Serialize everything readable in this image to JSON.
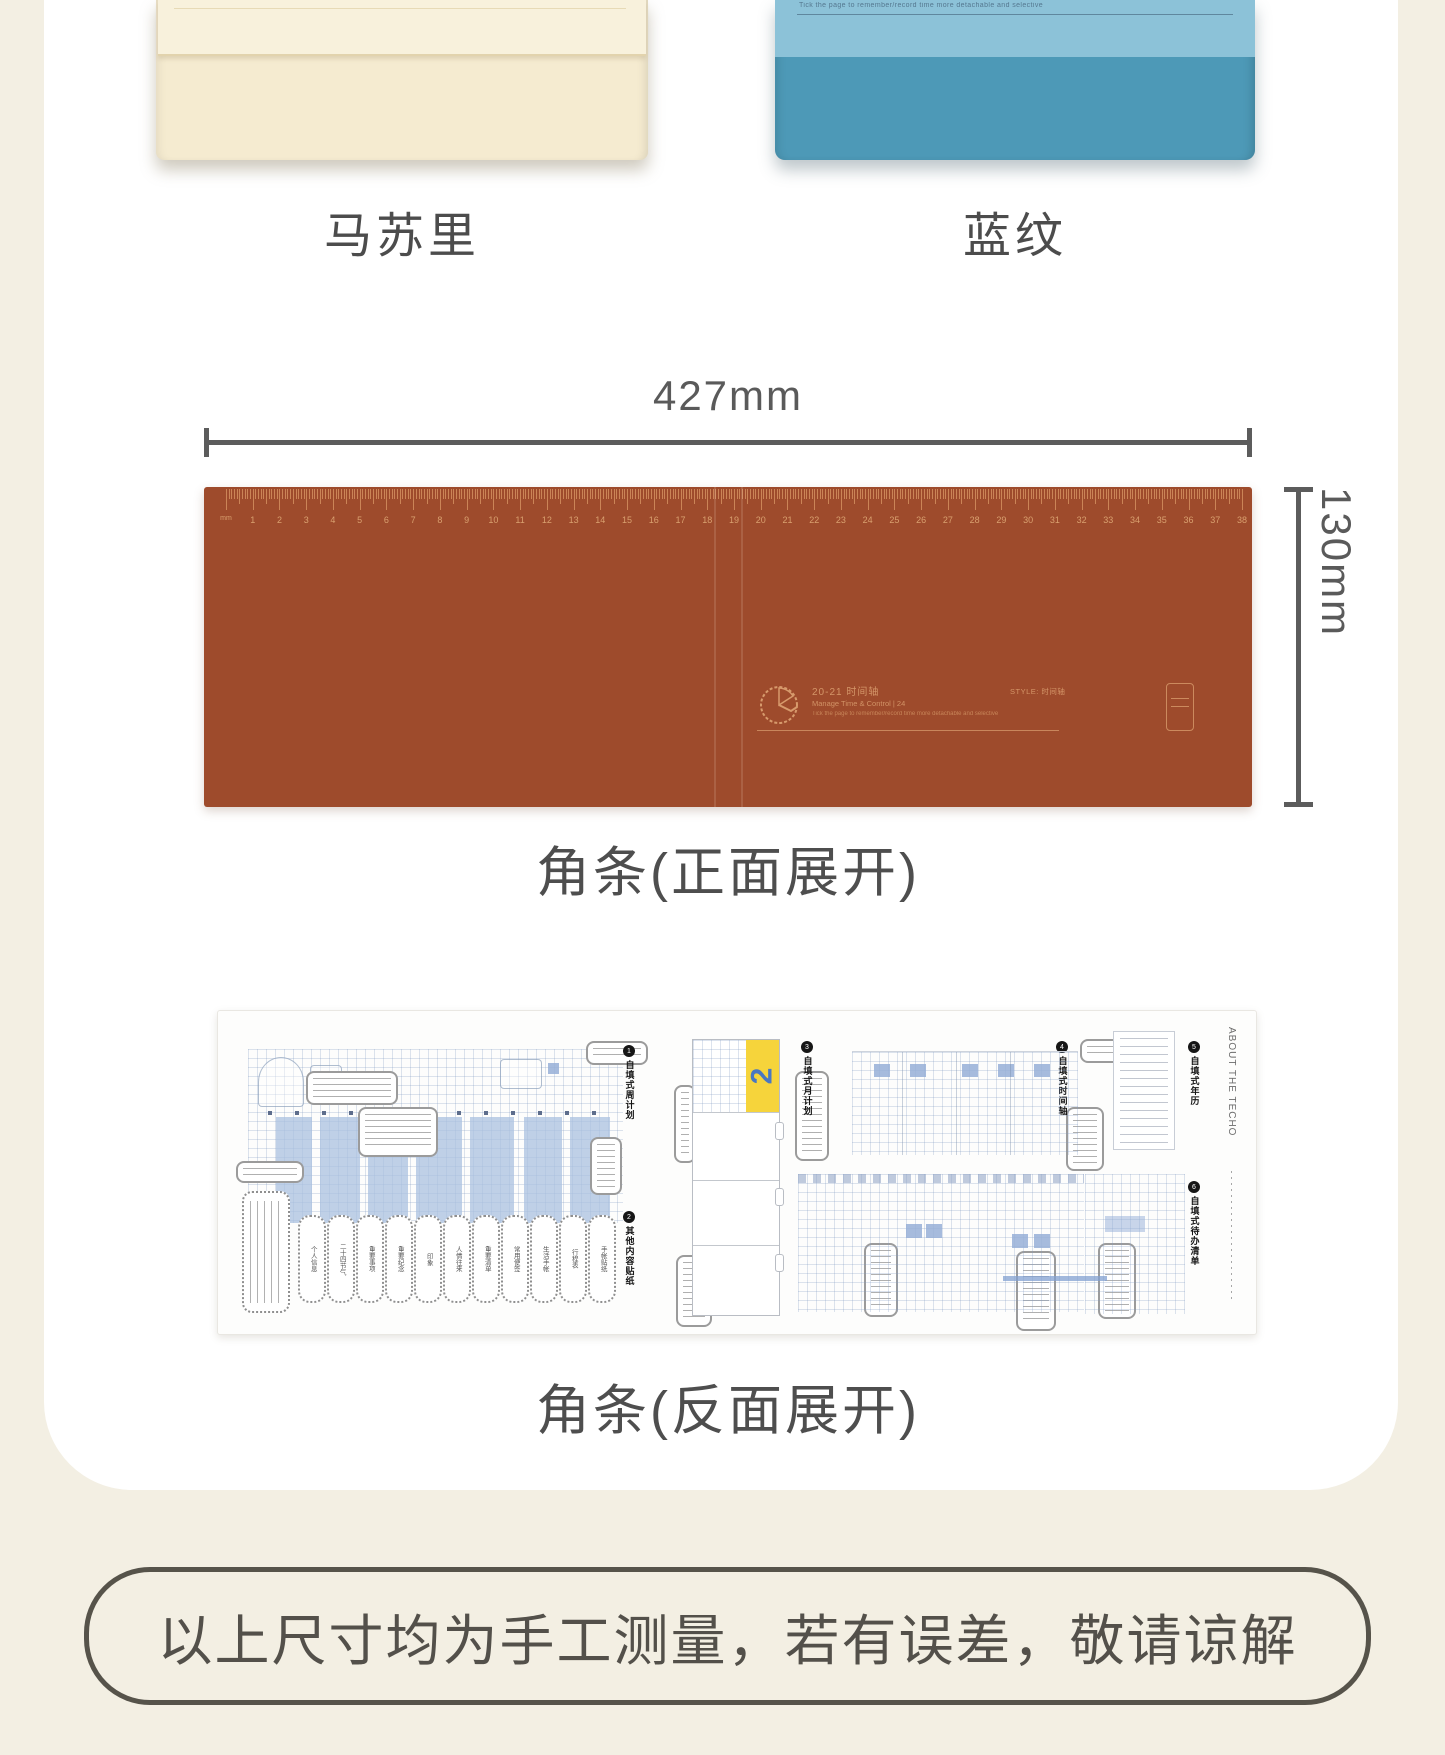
{
  "page": {
    "background": "#f3efe3",
    "card_background": "#ffffff"
  },
  "products": {
    "left": {
      "label": "马苏里",
      "body_color": "#f5ebd0",
      "flap_color": "#f8f1dc"
    },
    "right": {
      "label": "蓝纹",
      "band_color": "#8cc2d8",
      "body_color": "#4d99b7",
      "micro_text": "Tick the page to remember/record time more detachable and selective"
    }
  },
  "dimensions": {
    "width_label": "427mm",
    "height_label": "130mm"
  },
  "front_strip": {
    "caption": "角条(正面展开)",
    "color": "#9e4b2c",
    "ruler": {
      "unit_label": "mm",
      "centimeters": 38,
      "tick_color": "#cd875a",
      "number_color": "#d9a06f"
    },
    "print": {
      "title": "20-21 时间轴",
      "subtitle": "Manage Time & Control | 24",
      "note": "Tick the page to remember/record time more detachable and selective",
      "style_label": "STYLE: 时间轴",
      "ink_color": "#d79a6c"
    }
  },
  "back_strip": {
    "caption": "角条(反面展开)",
    "tab_number": "2",
    "about_text": "ABOUT THE TECHO",
    "accent_yellow": "#f6d43b",
    "accent_blue": "#4a77c2",
    "sections": [
      {
        "num": "1",
        "label": "自填式周计划"
      },
      {
        "num": "2",
        "label": "其他内容贴纸"
      },
      {
        "num": "3",
        "label": "自填式月计划"
      },
      {
        "num": "4",
        "label": "自填式时间轴"
      },
      {
        "num": "5",
        "label": "自填式年历"
      },
      {
        "num": "6",
        "label": "自填式待办清单"
      }
    ],
    "pills": [
      "个人信息",
      "二十四节气",
      "重要事项",
      "重要纪念",
      "印象",
      "人情往来",
      "重要清单",
      "常用便签",
      "生活手帐",
      "行程表",
      "手帐贴纸"
    ]
  },
  "disclaimer": {
    "text": "以上尺寸均为手工测量，若有误差，敬请谅解"
  }
}
